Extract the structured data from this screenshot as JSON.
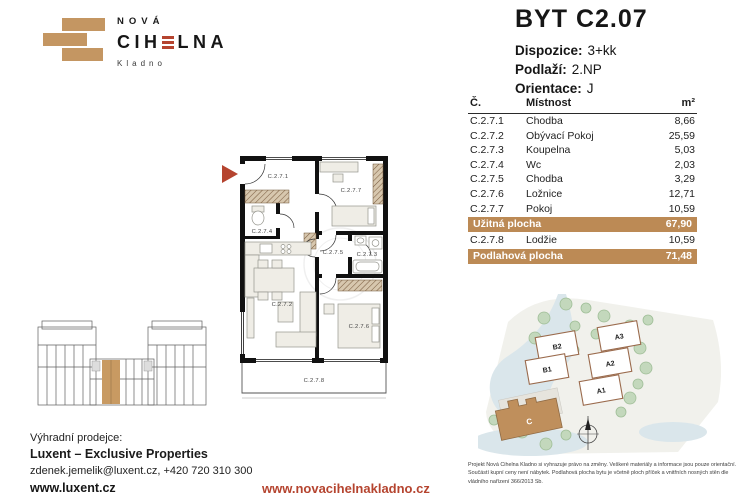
{
  "colors": {
    "tan": "#C49662",
    "tan_dark": "#BC8A55",
    "red": "#B5442F"
  },
  "logo": {
    "top": "NOVÁ",
    "main_left": "CIH",
    "main_right": "LNA",
    "city": "Kladno"
  },
  "header": {
    "title": "BYT C2.07",
    "specs": [
      {
        "label": "Dispozice:",
        "value": "3+kk"
      },
      {
        "label": "Podlaží:",
        "value": "2.NP"
      },
      {
        "label": "Orientace:",
        "value": "J"
      }
    ]
  },
  "table": {
    "col_num": "Č.",
    "col_room": "Místnost",
    "col_area": "m²",
    "rows": [
      {
        "num": "C.2.7.1",
        "room": "Chodba",
        "area": "8,66"
      },
      {
        "num": "C.2.7.2",
        "room": "Obývací Pokoj",
        "area": "25,59"
      },
      {
        "num": "C.2.7.3",
        "room": "Koupelna",
        "area": "5,03"
      },
      {
        "num": "C.2.7.4",
        "room": "Wc",
        "area": "2,03"
      },
      {
        "num": "C.2.7.5",
        "room": "Chodba",
        "area": "3,29"
      },
      {
        "num": "C.2.7.6",
        "room": "Ložnice",
        "area": "12,71"
      },
      {
        "num": "C.2.7.7",
        "room": "Pokoj",
        "area": "10,59"
      }
    ],
    "usable": {
      "label": "Užitná plocha",
      "value": "67,90"
    },
    "loggia_row": {
      "num": "C.2.7.8",
      "room": "Lodžie",
      "area": "10,59"
    },
    "floor_total": {
      "label": "Podlahová plocha",
      "value": "71,48"
    }
  },
  "floorplan": {
    "labels": [
      "C.2.7.1",
      "C.2.7.2",
      "C.2.7.3",
      "C.2.7.4",
      "C.2.7.5",
      "C.2.7.6",
      "C.2.7.7",
      "C.2.7.8"
    ]
  },
  "siteplan": {
    "buildings": [
      "B2",
      "B1",
      "A3",
      "A2",
      "A1"
    ],
    "highlighted": "C"
  },
  "footer": {
    "seller_label": "Výhradní prodejce:",
    "seller_name": "Luxent – Exclusive Properties",
    "contact": "zdenek.jemelik@luxent.cz, +420 720 310 300",
    "seller_web": "www.luxent.cz",
    "project_web": "www.novacihelnakladno.cz",
    "disclaimer": "Projekt Nová Cihelna Kladno si vyhrazuje právo na změny. Veškeré materiály a informace jsou pouze orientační. Součástí kupní ceny není nábytek. Podlahová plocha bytu je včetně ploch příček a vnitřních nosných stěn dle vládního nařízení 366/2013 Sb."
  }
}
